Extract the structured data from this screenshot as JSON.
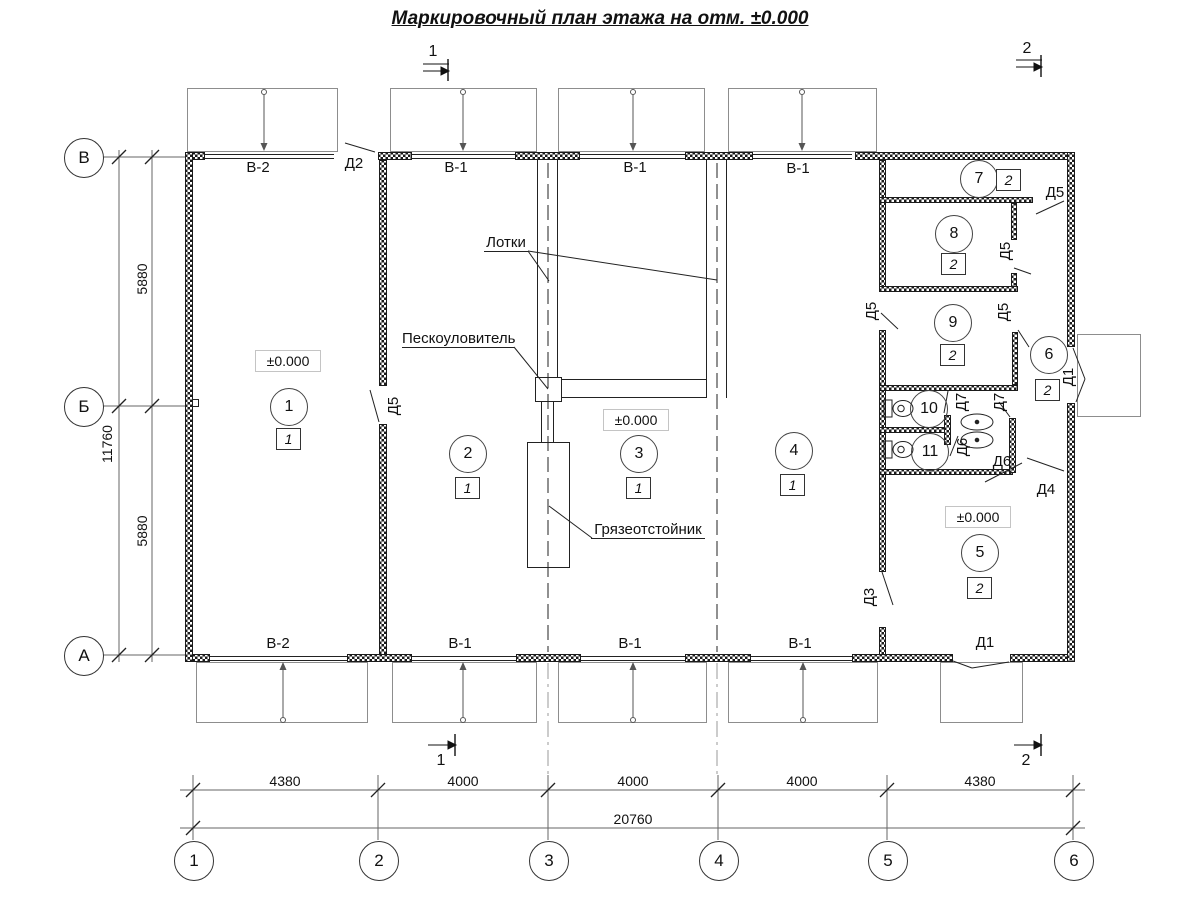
{
  "title": "Маркировочный план этажа на отм. ±0.000",
  "sections": {
    "top_left": "1",
    "top_right": "2",
    "bottom_left": "1",
    "bottom_right": "2"
  },
  "axes": {
    "rows": [
      "В",
      "Б",
      "А"
    ],
    "cols": [
      "1",
      "2",
      "3",
      "4",
      "5",
      "6"
    ]
  },
  "dims": {
    "bottom_segments": [
      "4380",
      "4000",
      "4000",
      "4000",
      "4380"
    ],
    "bottom_total": "20760",
    "left_segments": [
      "5880",
      "5880"
    ],
    "left_total": "11760"
  },
  "windows": {
    "top": [
      "В-2",
      "В-1",
      "В-1",
      "В-1"
    ],
    "bottom": [
      "В-2",
      "В-1",
      "В-1",
      "В-1"
    ]
  },
  "door_labels": [
    "Д2",
    "Д5",
    "Д5",
    "Д5",
    "Д5",
    "Д5",
    "Д7",
    "Д7",
    "Д6",
    "Д6",
    "Д4",
    "Д3",
    "Д1",
    "Д1"
  ],
  "rooms": [
    {
      "number": "1",
      "mark": "1"
    },
    {
      "number": "2",
      "mark": "1"
    },
    {
      "number": "3",
      "mark": "1"
    },
    {
      "number": "4",
      "mark": "1"
    },
    {
      "number": "5",
      "mark": "2"
    },
    {
      "number": "6",
      "mark": "2"
    },
    {
      "number": "7",
      "mark": "2"
    },
    {
      "number": "8",
      "mark": "2"
    },
    {
      "number": "9",
      "mark": "2"
    },
    {
      "number": "10"
    },
    {
      "number": "11"
    }
  ],
  "elevations": [
    "±0.000",
    "±0.000",
    "±0.000"
  ],
  "annotations": {
    "trays": "Лотки",
    "sand_trap": "Пескоуловитель",
    "mud_settler": "Грязеотстойник"
  }
}
